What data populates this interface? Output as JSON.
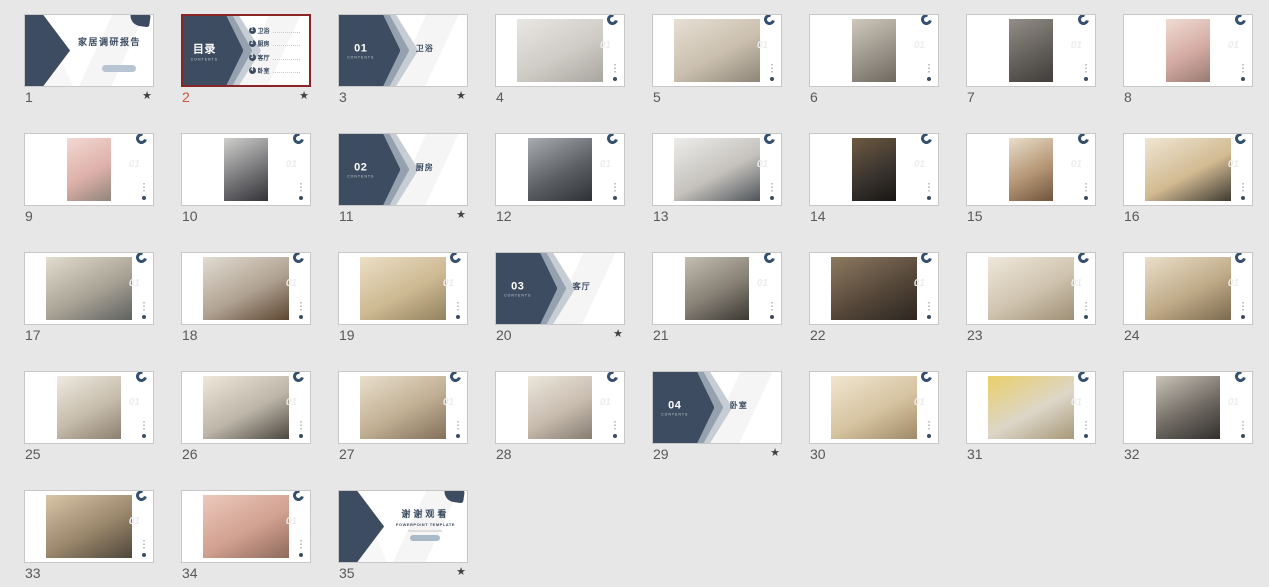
{
  "view": {
    "name": "powerpoint-slide-sorter",
    "background": "#e7e7e7",
    "slide_count": 35,
    "selected_slide": "2"
  },
  "theme": {
    "navy": "#3d4c61",
    "chevron_mid": "#96a1af",
    "chevron_light": "#c7cdd5",
    "selection_border": "#8b2426",
    "selected_number": "#d0543c",
    "number_color": "#595959",
    "thumb_border": "#c7c7c7",
    "watermark_color": "#ededed"
  },
  "strings": {
    "title_slide": {
      "title": "家居调研报告"
    },
    "toc": {
      "heading": "目录",
      "subheading": "CONTENTS",
      "items": [
        {
          "num": "1",
          "label": "卫浴"
        },
        {
          "num": "2",
          "label": "厨房"
        },
        {
          "num": "3",
          "label": "客厅"
        },
        {
          "num": "4",
          "label": "卧室"
        }
      ]
    },
    "sections": [
      {
        "num": "01",
        "label": "卫浴"
      },
      {
        "num": "02",
        "label": "厨房"
      },
      {
        "num": "03",
        "label": "客厅"
      },
      {
        "num": "04",
        "label": "卧室"
      }
    ],
    "closing": {
      "title": "谢谢观看",
      "subtitle": "POWERPOINT TEMPLATE"
    },
    "photo_watermark": "01",
    "star_glyph": "★"
  },
  "slides": [
    {
      "number": "1",
      "type": "title",
      "starred": true
    },
    {
      "number": "2",
      "type": "toc",
      "starred": true,
      "selected": true
    },
    {
      "number": "3",
      "type": "section",
      "section": 0,
      "starred": true
    },
    {
      "number": "4",
      "type": "photo",
      "starred": false,
      "photo": {
        "w": "landscape",
        "colors": [
          "#e9e7e3",
          "#cfccc6",
          "#a9a6a0"
        ]
      }
    },
    {
      "number": "5",
      "type": "photo",
      "starred": false,
      "photo": {
        "w": "landscape",
        "colors": [
          "#e6dfd4",
          "#cabfae",
          "#8d8578"
        ]
      }
    },
    {
      "number": "6",
      "type": "photo",
      "starred": false,
      "photo": {
        "w": "portrait",
        "colors": [
          "#cfc8bb",
          "#9b948a",
          "#6e6960"
        ]
      }
    },
    {
      "number": "7",
      "type": "photo",
      "starred": false,
      "photo": {
        "w": "portrait",
        "colors": [
          "#938e88",
          "#635f5a",
          "#403d3a"
        ]
      }
    },
    {
      "number": "8",
      "type": "photo",
      "starred": false,
      "photo": {
        "w": "portrait",
        "colors": [
          "#f0dcd4",
          "#d3aaa2",
          "#987a72"
        ]
      }
    },
    {
      "number": "9",
      "type": "photo",
      "starred": false,
      "photo": {
        "w": "portrait",
        "colors": [
          "#f2d8d2",
          "#dfb0aa",
          "#90857c"
        ]
      }
    },
    {
      "number": "10",
      "type": "photo",
      "starred": false,
      "photo": {
        "w": "portrait",
        "colors": [
          "#cfcfcd",
          "#77777a",
          "#323236"
        ]
      }
    },
    {
      "number": "11",
      "type": "section",
      "section": 1,
      "starred": true
    },
    {
      "number": "12",
      "type": "photo",
      "starred": false,
      "photo": {
        "w": "medium",
        "colors": [
          "#a8acb0",
          "#5d6165",
          "#2e3236"
        ]
      }
    },
    {
      "number": "13",
      "type": "photo",
      "starred": false,
      "photo": {
        "w": "landscape",
        "colors": [
          "#ececea",
          "#c5c2bd",
          "#4f545a"
        ]
      }
    },
    {
      "number": "14",
      "type": "photo",
      "starred": false,
      "photo": {
        "w": "portrait",
        "colors": [
          "#6e5a40",
          "#3b3530",
          "#171513"
        ]
      }
    },
    {
      "number": "15",
      "type": "photo",
      "starred": false,
      "photo": {
        "w": "portrait",
        "colors": [
          "#e9decb",
          "#b59675",
          "#6f553c"
        ]
      }
    },
    {
      "number": "16",
      "type": "photo",
      "starred": false,
      "photo": {
        "w": "landscape",
        "colors": [
          "#efe6d2",
          "#d2ba92",
          "#3f3b32"
        ]
      }
    },
    {
      "number": "17",
      "type": "photo",
      "starred": false,
      "photo": {
        "w": "landscape",
        "colors": [
          "#e3ddcf",
          "#a9a396",
          "#5f6260"
        ]
      }
    },
    {
      "number": "18",
      "type": "photo",
      "starred": false,
      "photo": {
        "w": "landscape",
        "colors": [
          "#e2dcd2",
          "#b0a292",
          "#5c4630"
        ]
      }
    },
    {
      "number": "19",
      "type": "photo",
      "starred": false,
      "photo": {
        "w": "landscape",
        "colors": [
          "#ecdfc6",
          "#cdb992",
          "#93815f"
        ]
      }
    },
    {
      "number": "20",
      "type": "section",
      "section": 2,
      "starred": true
    },
    {
      "number": "21",
      "type": "photo",
      "starred": false,
      "photo": {
        "w": "medium",
        "colors": [
          "#c3bdb2",
          "#857f74",
          "#3b3833"
        ]
      }
    },
    {
      "number": "22",
      "type": "photo",
      "starred": false,
      "photo": {
        "w": "landscape",
        "colors": [
          "#8d7a60",
          "#56483a",
          "#2c2620"
        ]
      }
    },
    {
      "number": "23",
      "type": "photo",
      "starred": false,
      "photo": {
        "w": "landscape",
        "colors": [
          "#efe8db",
          "#cfc3ae",
          "#9e8f76"
        ]
      }
    },
    {
      "number": "24",
      "type": "photo",
      "starred": false,
      "photo": {
        "w": "landscape",
        "colors": [
          "#eadfca",
          "#c0ab88",
          "#7c6a4e"
        ]
      }
    },
    {
      "number": "25",
      "type": "photo",
      "starred": false,
      "photo": {
        "w": "medium",
        "colors": [
          "#eee9e0",
          "#c6bcab",
          "#8c8070"
        ]
      }
    },
    {
      "number": "26",
      "type": "photo",
      "starred": false,
      "photo": {
        "w": "landscape",
        "colors": [
          "#efe8da",
          "#bdb5a8",
          "#4c4840"
        ]
      }
    },
    {
      "number": "27",
      "type": "photo",
      "starred": false,
      "photo": {
        "w": "landscape",
        "colors": [
          "#eadfcd",
          "#bfae92",
          "#82705a"
        ]
      }
    },
    {
      "number": "28",
      "type": "photo",
      "starred": false,
      "photo": {
        "w": "medium",
        "colors": [
          "#ece6dc",
          "#c8bcae",
          "#857c70"
        ]
      }
    },
    {
      "number": "29",
      "type": "section",
      "section": 3,
      "starred": true
    },
    {
      "number": "30",
      "type": "photo",
      "starred": false,
      "photo": {
        "w": "landscape",
        "colors": [
          "#f0e6d0",
          "#d6c3a0",
          "#a08a68"
        ]
      }
    },
    {
      "number": "31",
      "type": "photo",
      "starred": false,
      "photo": {
        "w": "landscape",
        "colors": [
          "#e9cf6a",
          "#ddd6c8",
          "#a79878"
        ]
      }
    },
    {
      "number": "32",
      "type": "photo",
      "starred": false,
      "photo": {
        "w": "medium",
        "colors": [
          "#c9c3b8",
          "#6f6a62",
          "#322f2c"
        ]
      }
    },
    {
      "number": "33",
      "type": "photo",
      "starred": false,
      "photo": {
        "w": "landscape",
        "colors": [
          "#d9c6a8",
          "#9a876c",
          "#4e463a"
        ]
      }
    },
    {
      "number": "34",
      "type": "photo",
      "starred": false,
      "photo": {
        "w": "landscape",
        "colors": [
          "#ecc9bc",
          "#d1a090",
          "#8e6a5c"
        ]
      }
    },
    {
      "number": "35",
      "type": "closing",
      "starred": true
    }
  ]
}
